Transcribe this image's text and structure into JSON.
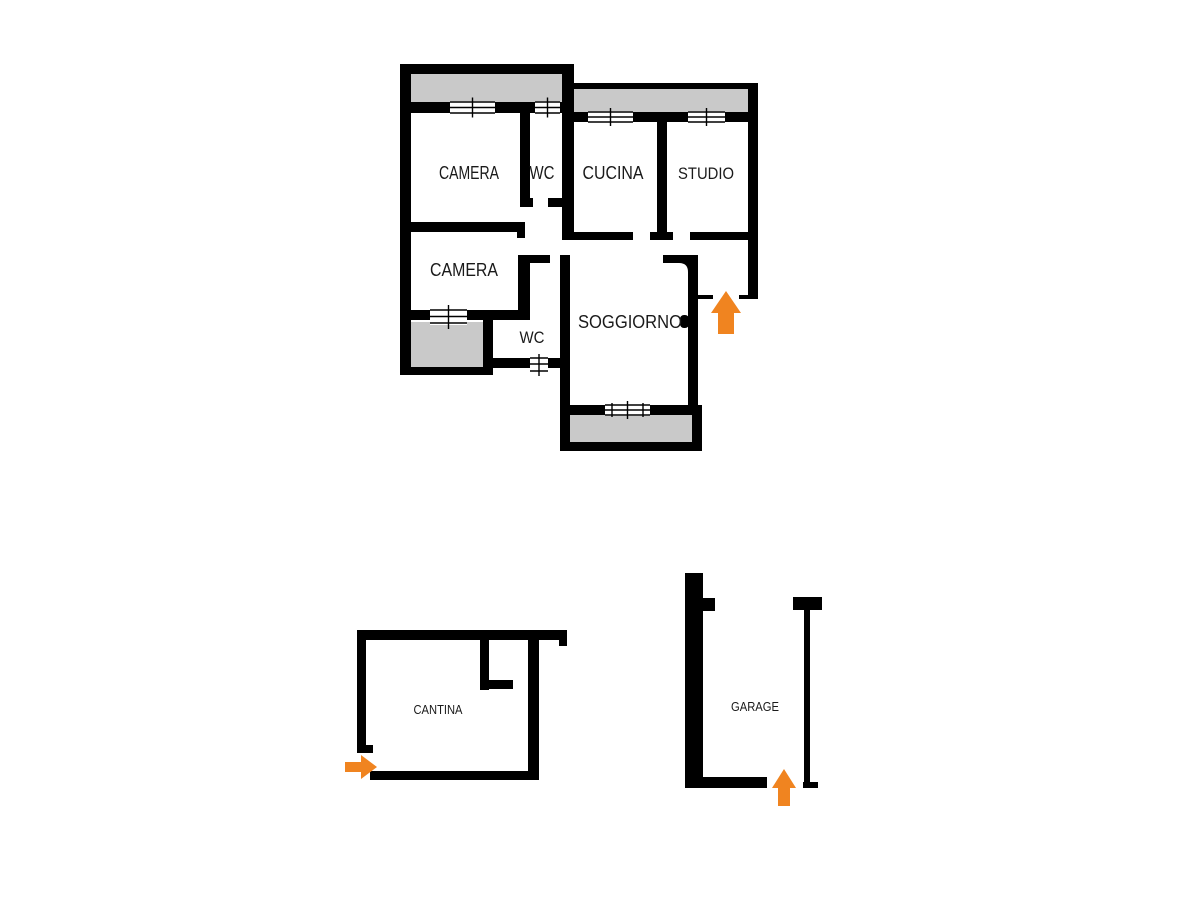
{
  "document": {
    "kind": "real-estate floor plan",
    "background": "#ffffff"
  },
  "colors": {
    "wall": "#000000",
    "balcony_fill": "#c9c9c9",
    "arrow_orange": "#f08420",
    "window_fill": "#ffffff"
  },
  "apartment": {
    "rooms": {
      "camera_top": "CAMERA",
      "wc_top": "WC",
      "cucina": "CUCINA",
      "studio": "STUDIO",
      "camera_bottom": "CAMERA",
      "wc_bottom": "WC",
      "soggiorno": "SOGGIORNO"
    },
    "entrance_arrow_direction": "up"
  },
  "cantina": {
    "label": "CANTINA",
    "entrance_arrow_direction": "right"
  },
  "garage": {
    "label": "GARAGE",
    "entrance_arrow_direction": "up"
  }
}
